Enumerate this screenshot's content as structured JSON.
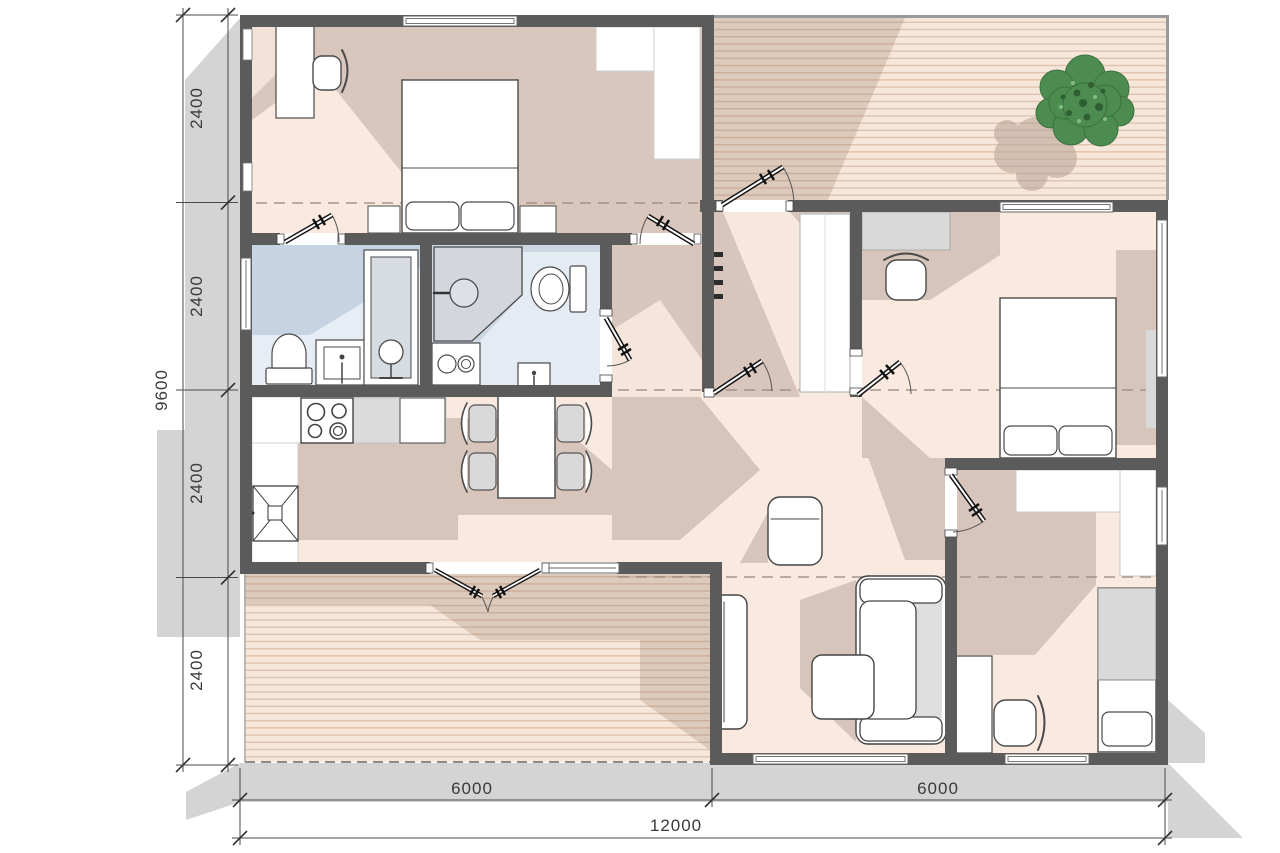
{
  "plan": {
    "title": "house-floor-plan",
    "dimensions": {
      "left": {
        "total": "9600",
        "segments": [
          "2400",
          "2400",
          "2400",
          "2400"
        ]
      },
      "bottom": {
        "segments": [
          "6000",
          "6000"
        ],
        "total": "12000"
      }
    },
    "colors": {
      "wall": "#5b5b5b",
      "floor_light": "#f9e9df",
      "floor_shadow": "#d8c5bb",
      "bathroom_light": "#e7edf5",
      "bathroom_shadow": "#c6d3e2",
      "deck_base": "#f6e7da",
      "deck_stripe": "#dfc3b0",
      "outside_shadow": "#d4d4d4",
      "furniture_gray": "#d9d9d9",
      "tree_green": "#4d8c50"
    }
  }
}
